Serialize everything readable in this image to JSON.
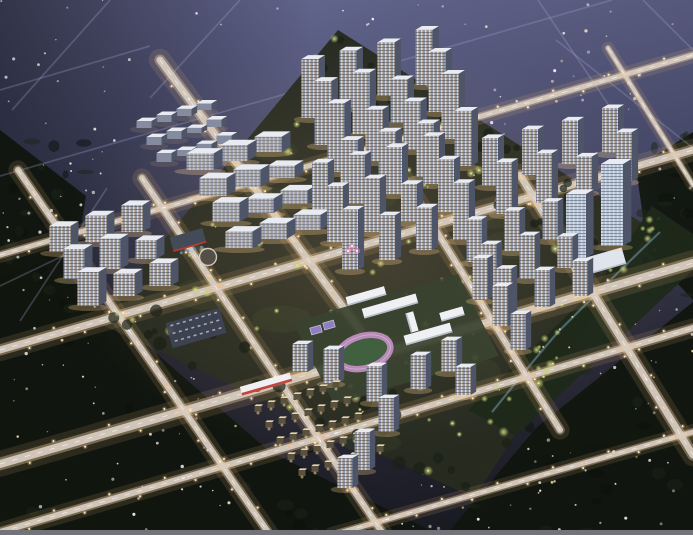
{
  "scene": {
    "title": "night-aerial-masterplan-rendering",
    "canvas": {
      "w": 693,
      "h": 535
    },
    "palette": {
      "sky_top": "#61648b",
      "sky_mid": "#4c4f71",
      "sky_low": "#303040",
      "ground": "#191a22",
      "forest": "#10150e",
      "forest_soft": "#1b2318",
      "road_glow": "#f2b97e",
      "road_mid": "#e6c9a0",
      "road_core": "#d8cdc1",
      "road_dash": "#ffffff",
      "faint_road": "#a3a8cf",
      "facade": "#8e96aa",
      "facade_slab": "#9aa1b2",
      "facade_dim": "#868ca0",
      "facade_office": "#b7c3d2",
      "side": "#4e5568",
      "roof": "#e8ebf2",
      "win_warm": "#ffdfa4",
      "win_cool": "#d5e6f6",
      "glow_warm": "#ffcf8f",
      "tree_lit": "#c9d27b",
      "tree_lit2": "#a9b95f",
      "tree_core": "#f1ee9b",
      "garden_light": "#ffd792",
      "track_ring": "#b78ab7",
      "track_field": "#41603f",
      "court": "#8f7fc0",
      "court_line": "#c8c4e8",
      "red_accent": "#c4372c",
      "blue_accent": "#5b8fd4",
      "stream": "#87b2c6",
      "star_cool": "#ffffff",
      "star_warm": "#ffe9b8",
      "neon_pink": "#ff8fd0",
      "dev_ground": "#262b1f",
      "dev_patch": "#323a26",
      "park_ground": "#1f291a",
      "school_ground": "#3a4230",
      "parking_fill": "#3f4556",
      "white": "#eef0f4",
      "bar": "#737479",
      "villa_roof": "#e7d6ae",
      "villa_body": "#5a523f",
      "slab_edge": "#b9bec9",
      "dark_roof": "#434a58"
    },
    "dev_diamond": [
      [
        338,
        30
      ],
      [
        650,
        228
      ],
      [
        474,
        498
      ],
      [
        96,
        322
      ]
    ],
    "forest_polys": [
      [
        [
          0,
          262
        ],
        [
          74,
          282
        ],
        [
          270,
          452
        ],
        [
          440,
          535
        ],
        [
          0,
          535
        ]
      ],
      [
        [
          446,
          535
        ],
        [
          536,
          428
        ],
        [
          693,
          302
        ],
        [
          693,
          535
        ]
      ],
      [
        [
          636,
          168
        ],
        [
          693,
          132
        ],
        [
          693,
          300
        ],
        [
          648,
          252
        ]
      ],
      [
        [
          0,
          130
        ],
        [
          86,
          196
        ],
        [
          64,
          336
        ],
        [
          0,
          302
        ]
      ]
    ],
    "roads_bright": [
      [
        0,
        255,
        693,
        55,
        5
      ],
      [
        0,
        350,
        693,
        150,
        7
      ],
      [
        0,
        464,
        693,
        263,
        8
      ],
      [
        0,
        532,
        693,
        328,
        6
      ],
      [
        332,
        535,
        693,
        432,
        5
      ],
      [
        18,
        170,
        270,
        535,
        6
      ],
      [
        142,
        178,
        384,
        535,
        6
      ],
      [
        160,
        60,
        360,
        330,
        7
      ],
      [
        352,
        95,
        560,
        430,
        6
      ],
      [
        520,
        175,
        693,
        455,
        7
      ],
      [
        608,
        48,
        693,
        185,
        4
      ]
    ],
    "roads_faint": [
      [
        0,
        176,
        612,
        0
      ],
      [
        110,
        0,
        12,
        110
      ],
      [
        240,
        0,
        150,
        98
      ],
      [
        538,
        0,
        608,
        104
      ],
      [
        643,
        0,
        693,
        50
      ],
      [
        0,
        90,
        150,
        46
      ],
      [
        693,
        148,
        556,
        40
      ],
      [
        107,
        188,
        20,
        321
      ],
      [
        0,
        286,
        96,
        240
      ]
    ],
    "star_regions": [
      [
        0,
        0,
        140,
        176,
        22
      ],
      [
        0,
        176,
        100,
        200,
        26
      ],
      [
        0,
        376,
        240,
        156,
        40
      ],
      [
        396,
        428,
        297,
        104,
        42
      ],
      [
        462,
        0,
        231,
        168,
        34
      ],
      [
        556,
        168,
        137,
        176,
        22
      ],
      [
        596,
        300,
        97,
        116,
        16
      ],
      [
        150,
        0,
        300,
        36,
        10
      ]
    ],
    "clusters": [
      {
        "name": "north-towers",
        "style": "res",
        "ox": 310,
        "oy": 118,
        "cols": 4,
        "rows": 4,
        "cdx": 38,
        "cdy": -11,
        "rdx": 13,
        "rdy": 27,
        "w": 17,
        "h": 64,
        "hv": 10
      },
      {
        "name": "northeast-towers",
        "style": "res",
        "ox": 490,
        "oy": 186,
        "cols": 4,
        "rows": 2,
        "cdx": 40,
        "cdy": -11,
        "rdx": 14,
        "rdy": 28,
        "w": 16,
        "h": 52,
        "hv": 8
      },
      {
        "name": "center-towers",
        "style": "res",
        "ox": 320,
        "oy": 214,
        "cols": 4,
        "rows": 3,
        "cdx": 37,
        "cdy": -10,
        "rdx": 15,
        "rdy": 28,
        "w": 16,
        "h": 56,
        "hv": 9
      },
      {
        "name": "east-towers",
        "style": "res",
        "ox": 474,
        "oy": 262,
        "cols": 3,
        "rows": 3,
        "cdx": 38,
        "cdy": -11,
        "rdx": 15,
        "rdy": 28,
        "w": 15,
        "h": 46,
        "hv": 7
      },
      {
        "name": "west-midrise-slabs",
        "style": "slab",
        "ox": 200,
        "oy": 170,
        "cols": 3,
        "rows": 4,
        "cdx": 34,
        "cdy": -9,
        "rdx": 13,
        "rdy": 26,
        "w": 27,
        "h": 18,
        "hv": 3
      },
      {
        "name": "west-cluster",
        "style": "res",
        "ox": 60,
        "oy": 252,
        "cols": 3,
        "rows": 3,
        "cdx": 36,
        "cdy": -10,
        "rdx": 14,
        "rdy": 27,
        "w": 21,
        "h": 30,
        "hv": 8
      },
      {
        "name": "northwest-lowrise",
        "style": "dim",
        "ox": 144,
        "oy": 128,
        "cols": 4,
        "rows": 3,
        "cdx": 20,
        "cdy": -6,
        "rdx": 10,
        "rdy": 17,
        "w": 15,
        "h": 8,
        "hv": 2
      }
    ],
    "south_towers": [
      [
        331,
        383,
        34
      ],
      [
        374,
        402,
        36
      ],
      [
        386,
        432,
        34
      ],
      [
        362,
        470,
        38
      ],
      [
        345,
        488,
        30
      ],
      [
        300,
        372,
        28
      ],
      [
        418,
        389,
        34
      ],
      [
        449,
        372,
        32
      ],
      [
        463,
        395,
        28
      ],
      [
        480,
        300,
        42
      ],
      [
        500,
        326,
        40
      ],
      [
        518,
        350,
        36
      ]
    ],
    "office_towers": [
      [
        576,
        258,
        64,
        20
      ],
      [
        612,
        246,
        82,
        22
      ]
    ],
    "office_podium": [
      598,
      263,
      54,
      17
    ],
    "villas": {
      "ox": 258,
      "oy": 412,
      "cols": 7,
      "rows": 5,
      "cdx": 13,
      "cdy": -4,
      "rdx": 11,
      "rdy": 16
    },
    "school": {
      "ground": [
        [
          293,
          322
        ],
        [
          458,
          274
        ],
        [
          499,
          356
        ],
        [
          334,
          404
        ]
      ],
      "track": {
        "cx": 364,
        "cy": 352,
        "rx": 27,
        "ry": 16,
        "rot": -16
      },
      "courts": [
        [
          316,
          330
        ],
        [
          329,
          325
        ]
      ],
      "slabs": [
        [
          390,
          306,
          56,
          10,
          -16
        ],
        [
          428,
          334,
          48,
          10,
          -16
        ],
        [
          366,
          296,
          40,
          9,
          -16
        ],
        [
          452,
          314,
          24,
          9,
          -16
        ],
        [
          412,
          322,
          20,
          8,
          74
        ]
      ]
    },
    "red_strips": [
      [
        266,
        384,
        52,
        9
      ]
    ],
    "kindergarten": [
      188,
      240,
      34,
      15
    ],
    "plaza": [
      208,
      257,
      8.5
    ],
    "parking": [
      196,
      328,
      56,
      26,
      -16
    ],
    "park_strip": {
      "poly": [
        [
          652,
          206
        ],
        [
          693,
          234
        ],
        [
          693,
          270
        ],
        [
          516,
          436
        ],
        [
          468,
          410
        ],
        [
          596,
          288
        ]
      ],
      "stream": "M660,232 C620,270 590,300 560,330 C540,352 510,390 492,412"
    },
    "neon_plaza": [
      [
        352,
        246
      ],
      [
        357,
        251
      ],
      [
        348,
        251
      ]
    ],
    "counts": {
      "trees_lit": 95,
      "dark_clumps": 55,
      "ground_patches": 16,
      "park_trees": 20,
      "park_lamps": 9
    },
    "bottom_bar": {
      "y": 530,
      "h": 5
    }
  }
}
